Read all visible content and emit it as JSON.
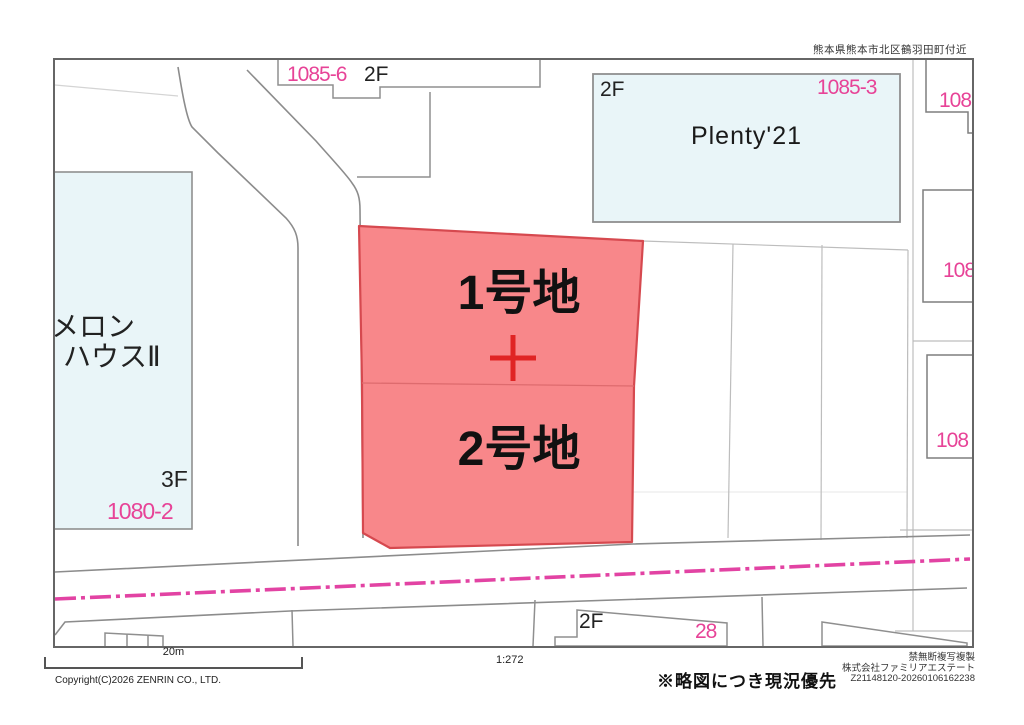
{
  "header": {
    "location": "熊本県熊本市北区鶴羽田町付近"
  },
  "map": {
    "lot1_label": "1号地",
    "lot2_label": "2号地",
    "melon_house_line1": "メロン",
    "melon_house_line2": "ハウスⅡ",
    "melon_house_floor": "3F",
    "melon_house_parcel": "1080-2",
    "top_building_parcel": "1085-6",
    "top_building_floor": "2F",
    "plenty_building_floor": "2F",
    "plenty_building_parcel": "1085-3",
    "plenty_building_name": "Plenty'21",
    "right_building_parcel_top": "108",
    "right_building_parcel_mid": "108",
    "right_building_parcel_bottom": "108",
    "bottom_building_floor": "2F",
    "bottom_building_parcel": "28"
  },
  "footer": {
    "scale_bar_label": "20m",
    "scale_ratio": "1:272",
    "copyright": "Copyright(C)2026 ZENRIN CO., LTD.",
    "notice": "※略図につき現況優先",
    "rights_line": "禁無断複写複製",
    "company_line": "株式会社ファミリアエステート",
    "serial_line": "Z21148120-20260106162238"
  },
  "colors": {
    "lot_fill": "#f8878a",
    "lot_border": "#d6494f",
    "lot_divider": "#de6b6e",
    "parcel_pink_text": "#e74397",
    "road_centerline_pink": "#e243a3",
    "building_fill": "#e9f5f8",
    "road_line_gray": "#8c8c8c",
    "parcel_line_gray": "#bdbdbd",
    "survey_cross_red": "#e02424"
  }
}
